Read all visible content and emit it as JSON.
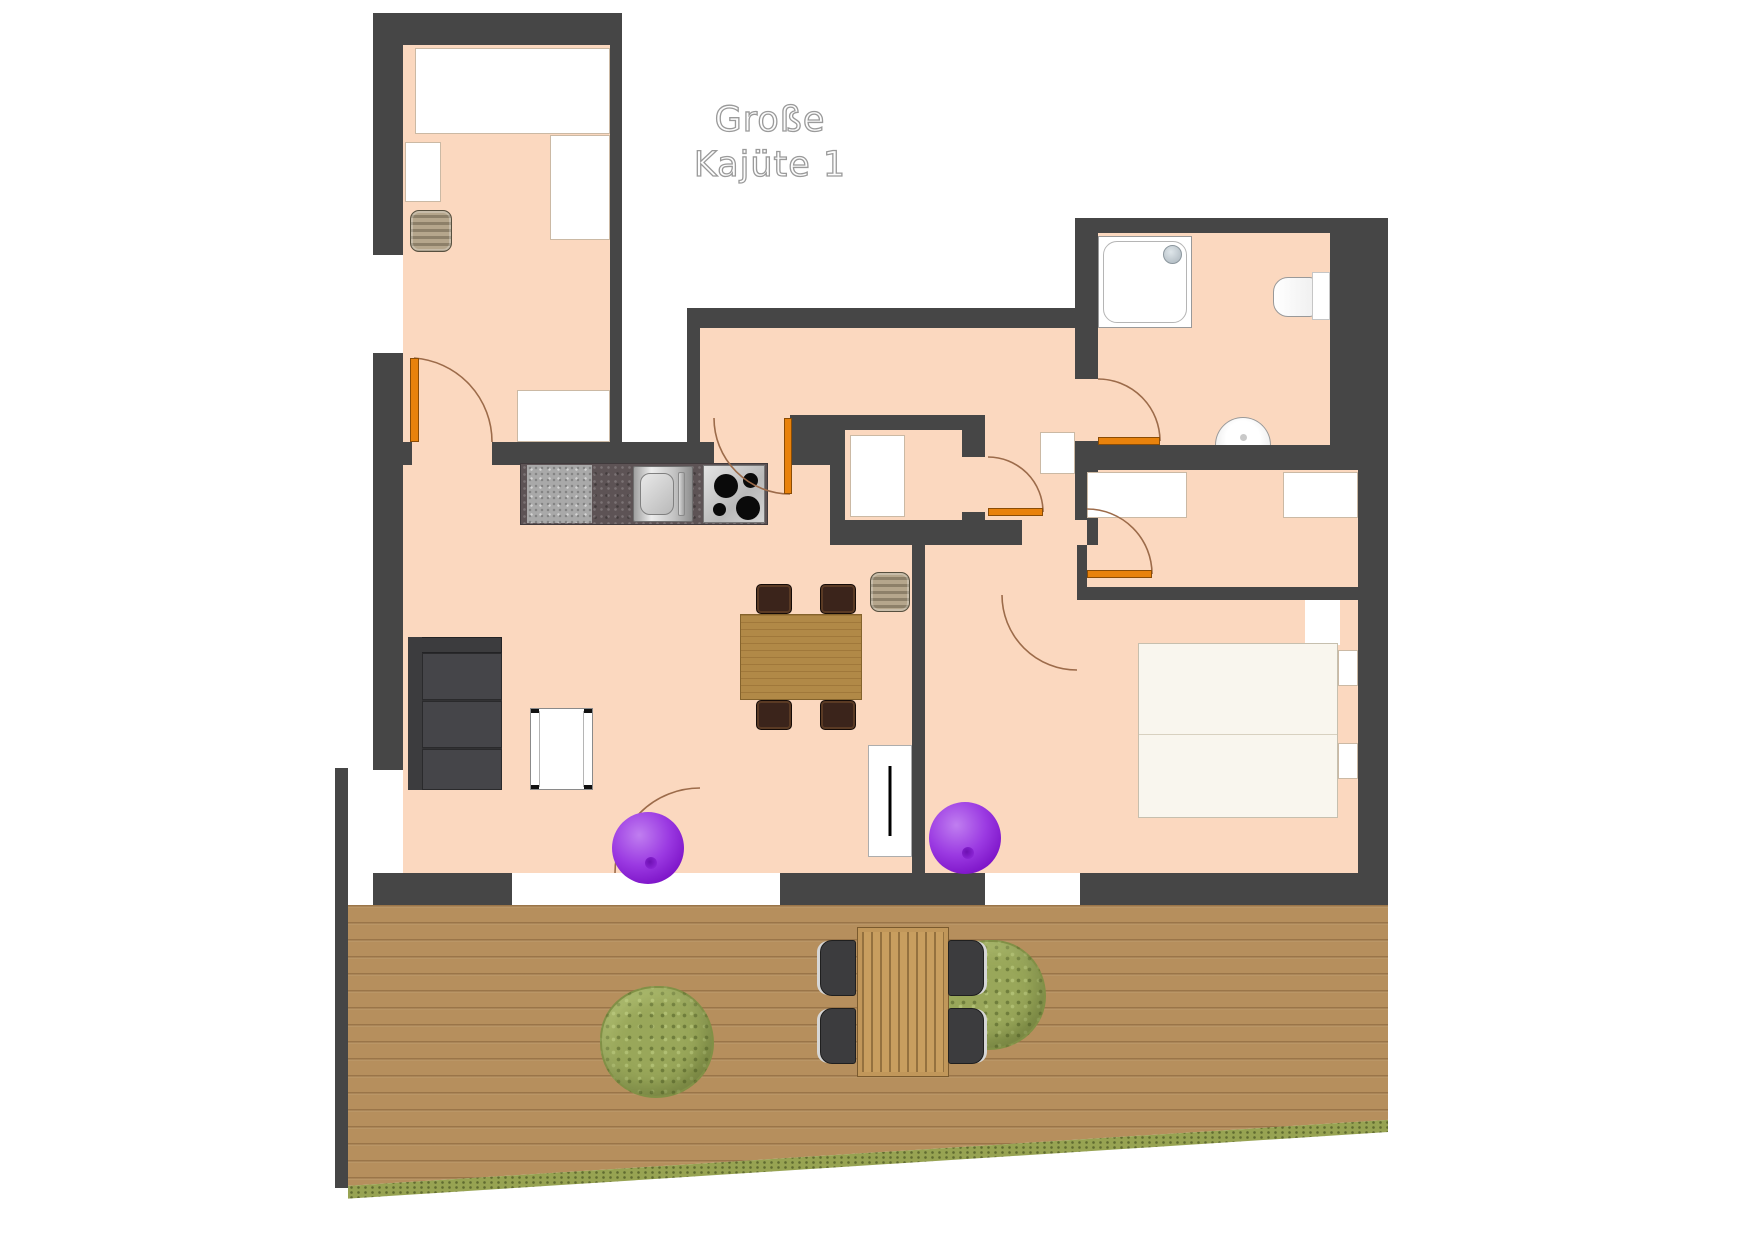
{
  "title": {
    "line1": "Große",
    "line2": "Kajüte 1"
  },
  "colors": {
    "wall": "#464646",
    "floor": "#fbd8bf",
    "door_leaf": "#e8820c",
    "door_arc": "#9c6b4a",
    "deck_wood": "#b68f5d",
    "grass": "#97a352",
    "bush": "#99a75a",
    "sofa": "#3c3c3e",
    "dining_wood": "#b18947",
    "chair_brown": "#3b241b",
    "purple": "#9b3ae2",
    "counter_dark": "#5d5355",
    "counter_light": "#a9a9a9",
    "bed": "#f9f6ee",
    "fixture_white": "#ffffff"
  }
}
